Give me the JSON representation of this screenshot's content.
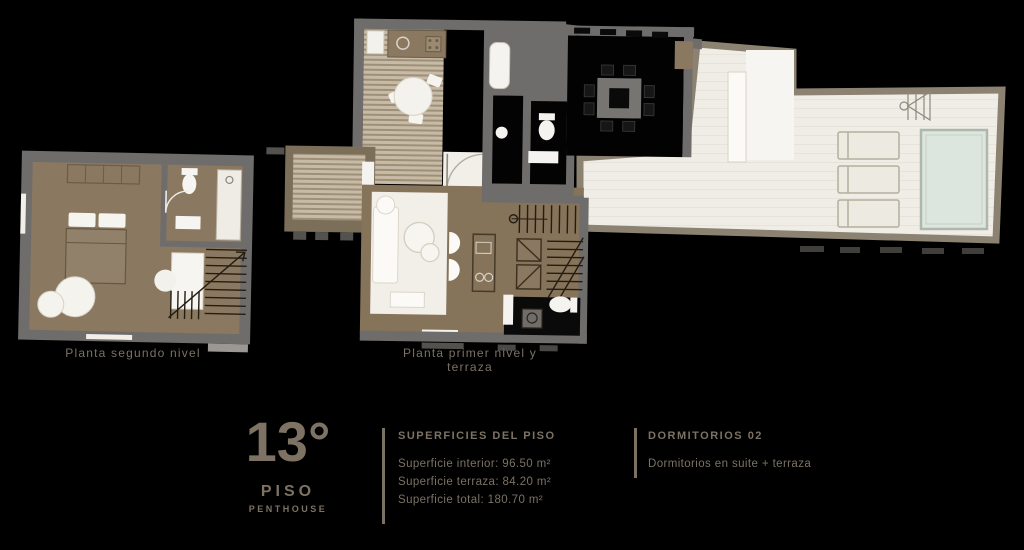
{
  "plans": {
    "upper": {
      "label": "Planta segundo nivel"
    },
    "lower": {
      "label": "Planta primer nivel y terraza"
    }
  },
  "legend": {
    "floor_number": "13°",
    "floor_word": "PISO",
    "floor_sub": "PENTHOUSE",
    "surfaces": {
      "heading": "SUPERFICIES DEL PISO",
      "lines": [
        "Superficie interior: 96.50 m²",
        "Superficie terraza: 84.20 m²",
        "Superficie total: 180.70 m²"
      ]
    },
    "details": {
      "heading": "DORMITORIOS 02",
      "line": "Dormitorios en suite + terraza"
    }
  },
  "icons": {
    "pool": "pool-icon",
    "shower": "outdoor-shower-icon",
    "stairs": "stairs-icon",
    "bed": "bed-icon",
    "toilet": "toilet-icon",
    "dining_table": "dining-table-icon",
    "sofa": "sofa-icon"
  },
  "colors": {
    "background": "#000000",
    "wall": "#6f6d6b",
    "floor_brown": "#8a7860",
    "living_floor": "#85735a",
    "deck_stripe_light": "#c7bba8",
    "deck_stripe_dark": "#9e8f77",
    "terrace_floor": "#f0ede7",
    "terrace_wall": "#8b8272",
    "pool_water": "#dde6de",
    "furniture_white": "#f6f4ef",
    "stair_line": "#241d12",
    "text": "#7b7264"
  }
}
